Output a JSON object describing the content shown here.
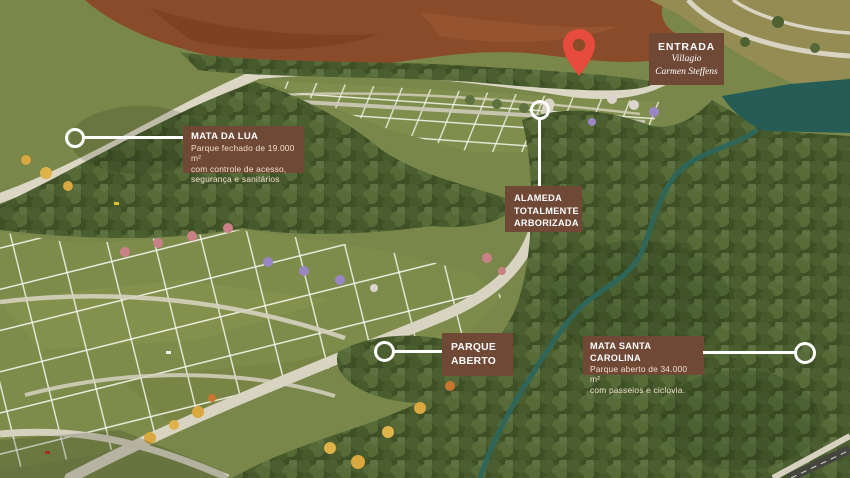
{
  "entrance": {
    "label": "ENTRADA",
    "project_name_line1": "Villagio",
    "project_name_line2": "Carmen Steffens"
  },
  "callouts": {
    "mata_da_lua": {
      "title": "MATA DA LUA",
      "desc_line1": "Parque fechado de 19.000 m²",
      "desc_line2": "com controle de acesso,",
      "desc_line3": "segurança e sanitários"
    },
    "alameda": {
      "title_line1": "ALAMEDA",
      "title_line2": "TOTALMENTE",
      "title_line3": "ARBORIZADA"
    },
    "parque_aberto": {
      "title_line1": "PARQUE",
      "title_line2": "ABERTO"
    },
    "mata_santa_carolina": {
      "title": "MATA SANTA CAROLINA",
      "desc_line1": "Parque aberto de 34.000 m²",
      "desc_line2": "com passeios e ciclovia."
    }
  },
  "colors": {
    "callout_brown": "#6f4836",
    "pin_red": "#e64b3b",
    "connector_white": "#ffffff",
    "water_teal": "#255d56",
    "field_green": "#79874a",
    "forest_green": "#3f5027",
    "dirt_brown": "#8a4b2a",
    "road_light": "#dcd7c5"
  }
}
